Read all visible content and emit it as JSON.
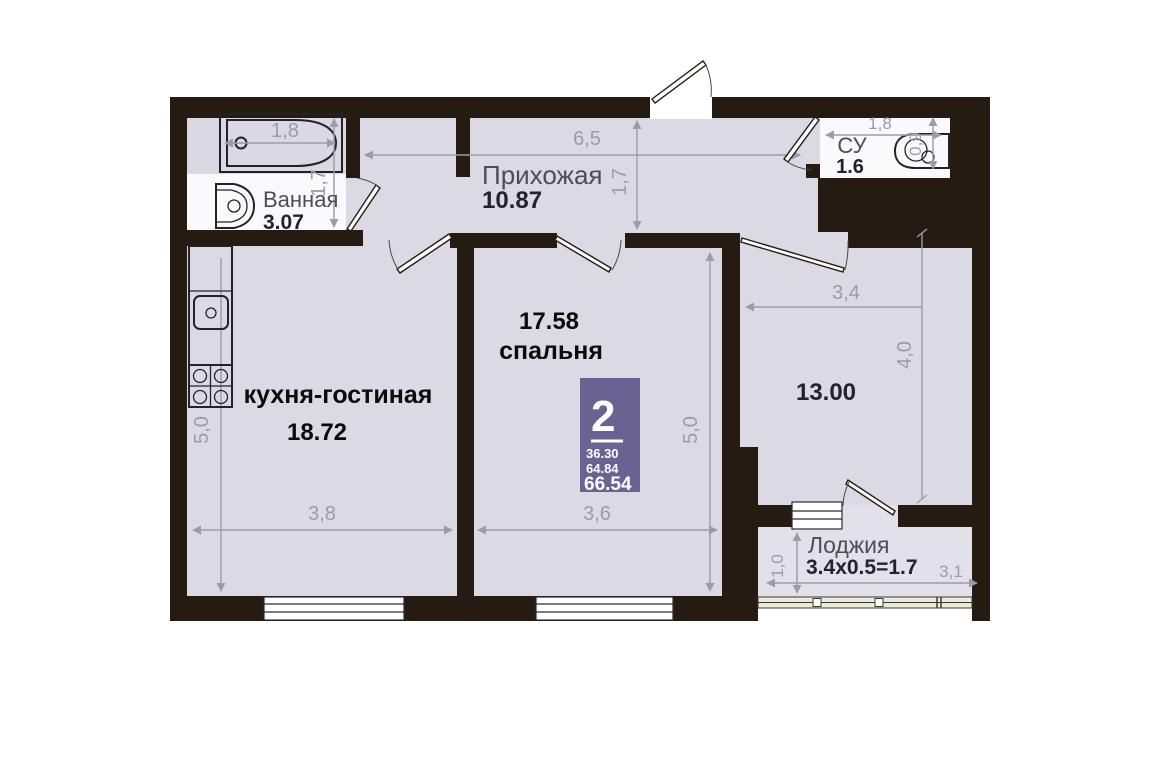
{
  "plan": {
    "title": "2-room apartment floor plan",
    "badge": {
      "rooms": "2",
      "value1": "36.30",
      "value2": "64.84",
      "total": "66.54",
      "color": "#6b6294"
    },
    "rooms": {
      "bathroom": {
        "name": "Ванная",
        "area": "3.07",
        "width": "1,8",
        "depth": "1,7"
      },
      "hallway": {
        "name": "Прихожая",
        "area": "10.87",
        "width": "6,5",
        "depth": "1,7"
      },
      "wc": {
        "name": "СУ",
        "area": "1.6",
        "width": "1,8",
        "depth": "0,9"
      },
      "kitchen_living": {
        "name": "кухня-гостиная",
        "area": "18.72",
        "width": "3,8",
        "depth": "5,0"
      },
      "bedroom": {
        "name": "спальня",
        "area": "17.58",
        "width": "3,6",
        "depth": "5,0"
      },
      "living_room": {
        "area": "13.00",
        "width": "3,4",
        "depth": "4,0"
      },
      "loggia": {
        "name": "Лоджия",
        "formula": "3.4x0.5=1.7",
        "width": "3,1",
        "depth": "1,0"
      }
    },
    "colors": {
      "wall": "#251b12",
      "floor": "#dbdae4",
      "wet_floor": "#fafafc",
      "loggia_floor": "#e2e1ea",
      "badge": "#6b6294",
      "dimension": "#9c9ba9",
      "label_gray": "#4d4c58",
      "number_dark": "#23222e",
      "overlay_black": "#0b0b0b"
    }
  }
}
